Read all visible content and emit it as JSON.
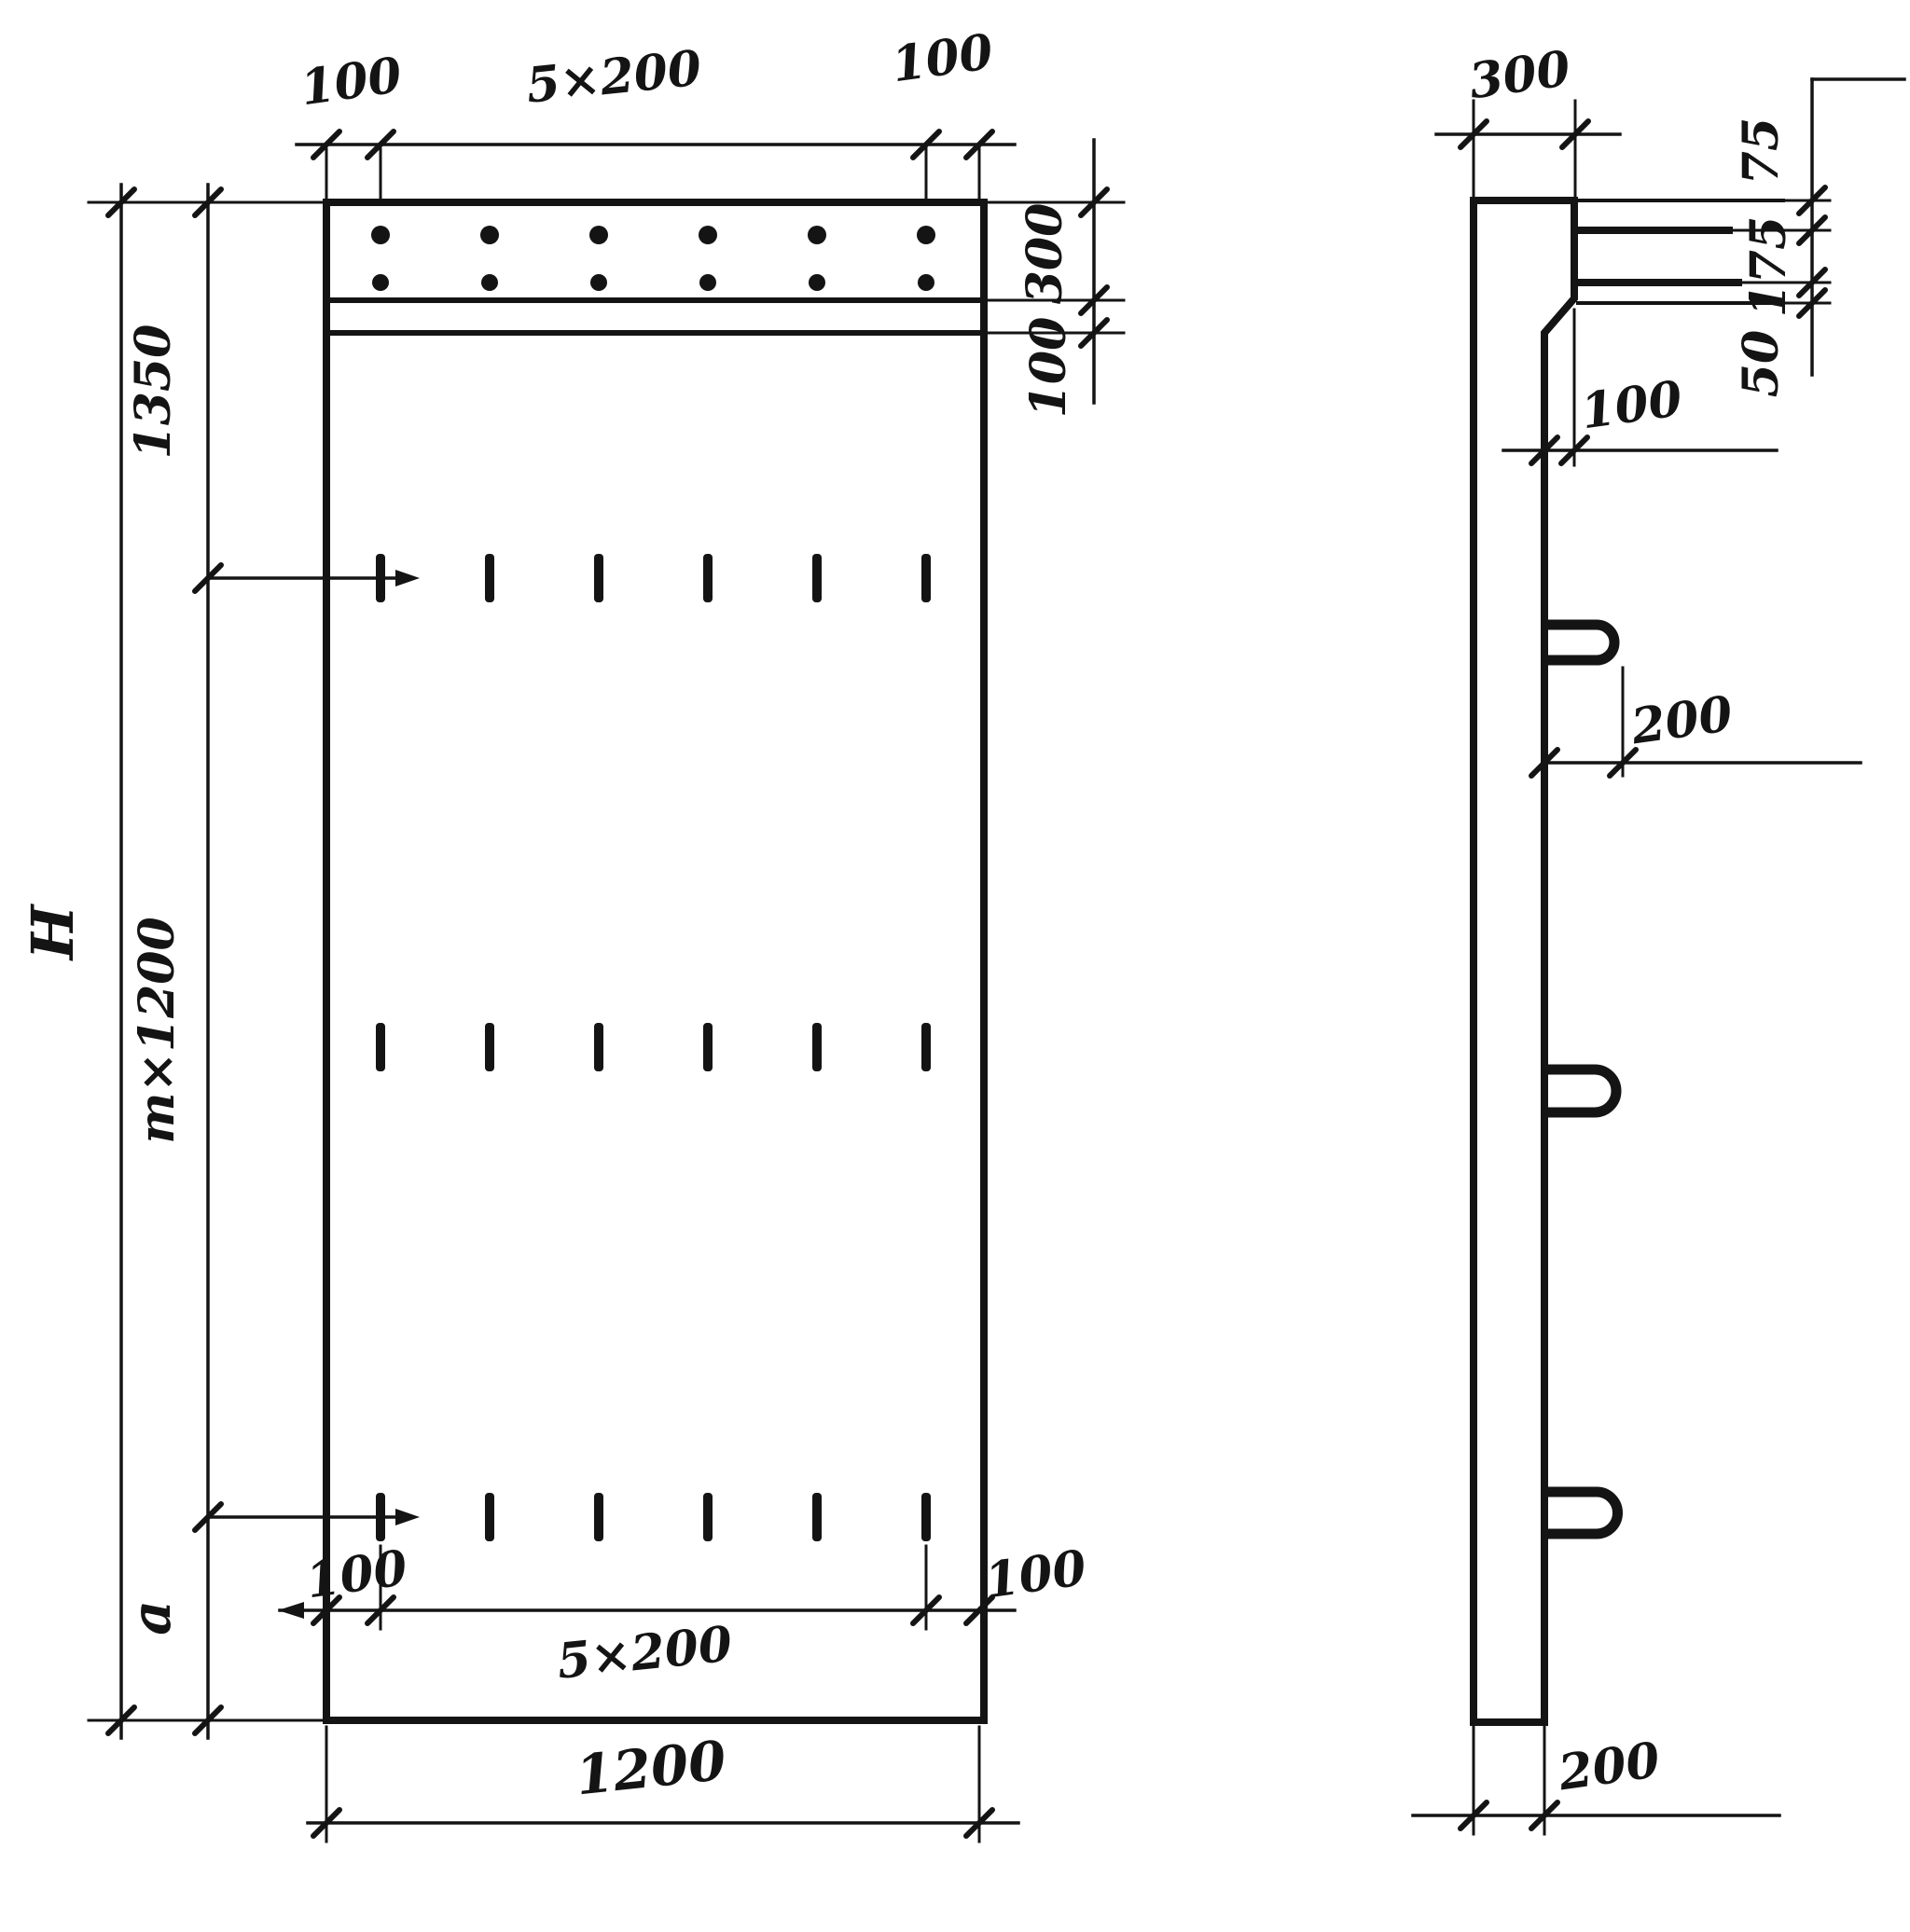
{
  "page": {
    "background": "#ffffff",
    "ink": "#141414"
  },
  "front": {
    "top_chain": {
      "left_margin": "100",
      "spacing": "5×200",
      "right_margin": "100"
    },
    "right_chain": {
      "band_height": "300",
      "band_offset": "100"
    },
    "left_chain": {
      "top": "1350",
      "middle": "m×1200",
      "bottom": "a",
      "overall_height": "H"
    },
    "bottom_chain": {
      "left_margin": "100",
      "spacing": "5×200",
      "right_margin": "100",
      "overall_width": "1200"
    }
  },
  "side": {
    "top_width": "300",
    "right_chain": {
      "top": "75",
      "middle": "175",
      "bottom": "50"
    },
    "step": "100",
    "loop_length": "200",
    "bottom_width": "200"
  }
}
